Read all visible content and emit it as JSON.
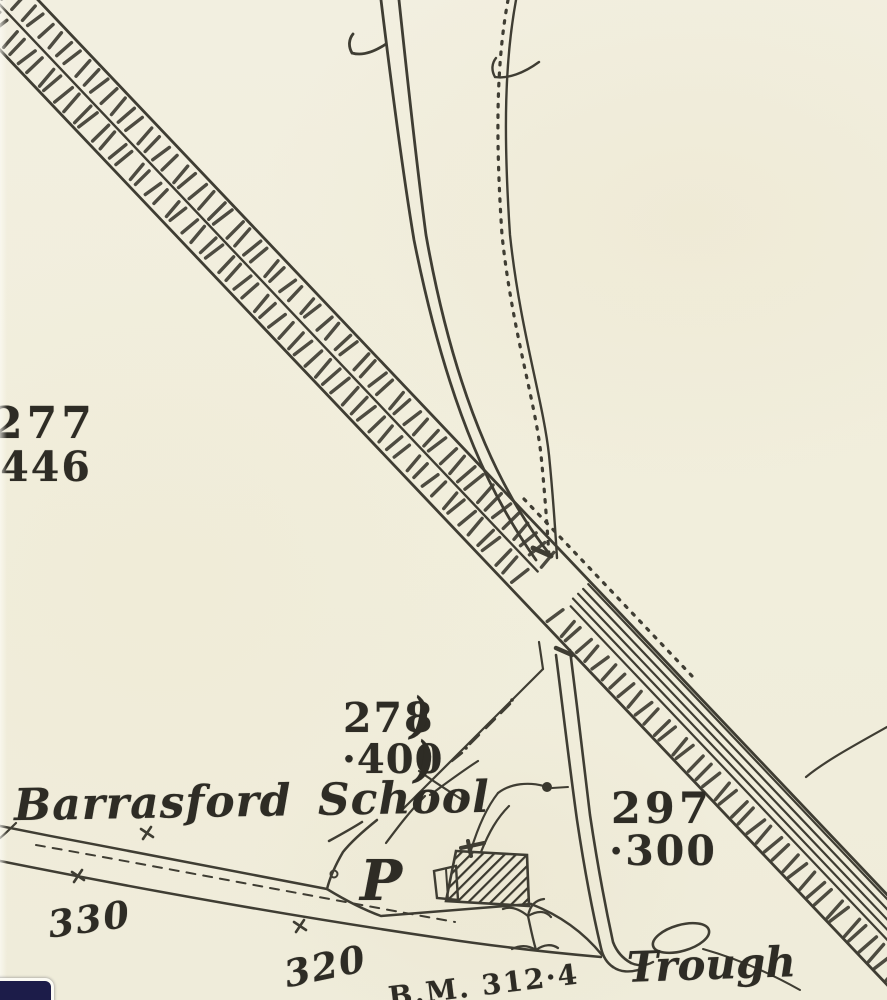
{
  "map": {
    "paper_color": "#f1eedd",
    "ink_color": "#3a382e",
    "labels": {
      "parcel_277": {
        "number": "277",
        "area": "·446"
      },
      "parcel_278": {
        "number": "278",
        "area": "·400"
      },
      "parcel_297": {
        "number": "297",
        "area": "·300"
      },
      "parcel_bracket": ")",
      "school_name": "Barrasford School",
      "p_symbol": "P",
      "trough": "Trough",
      "benchmark": "B.M. 312·4",
      "elevation_330": "330",
      "elevation_320": "320"
    }
  },
  "viewer": {
    "corner_button_color": "#1c1c49"
  }
}
